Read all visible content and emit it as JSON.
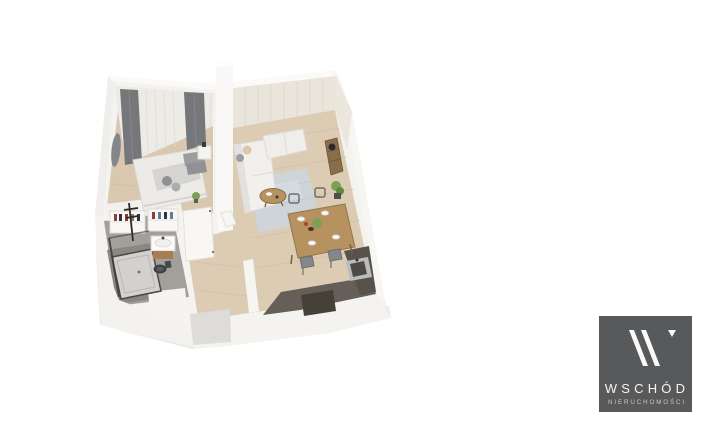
{
  "background": "#ffffff",
  "floor_plan": {
    "type": "isometric-3d-apartment-render",
    "rooms": [
      "bedroom",
      "living-room",
      "dining-area",
      "kitchen",
      "bathroom",
      "hallway"
    ]
  },
  "palette": {
    "wall": "#f4f3f0",
    "wall_bright": "#fbfaf8",
    "wall_shade": "#efeeea",
    "plinth_shade_left": "#e9e8e4",
    "plinth_shade_right": "#edebe7",
    "wood_floor": "#d9c7af",
    "wood_floor_2": "#ddccb4",
    "bathroom_floor": "#a3a09c",
    "bathroom_mat": "#8a8783",
    "kitchen_counter": "#655f58",
    "kitchen_recess": "#454038",
    "entry_recess": "#dddcd8",
    "curtain_sheer": "#edebe6",
    "curtain_beige": "#eae5da",
    "curtain_gray": "#75777b",
    "rug": "#ccd4d9",
    "sofa": "#f1f0ed",
    "bed": "#edebe8",
    "pillow_gray": "#9b9da0",
    "table_wood": "#b5925f",
    "plant_green": "#7ba053",
    "sink_metal": "#b9bdbe",
    "logo_bg": "#58595b",
    "logo_text": "#f5f5f4",
    "logo_subtext": "#c9c9c9"
  },
  "logo": {
    "title": "WSCHÓD",
    "subtitle": "NIERUCHOMOŚCI",
    "glyph": "w-double-slash-icon"
  }
}
